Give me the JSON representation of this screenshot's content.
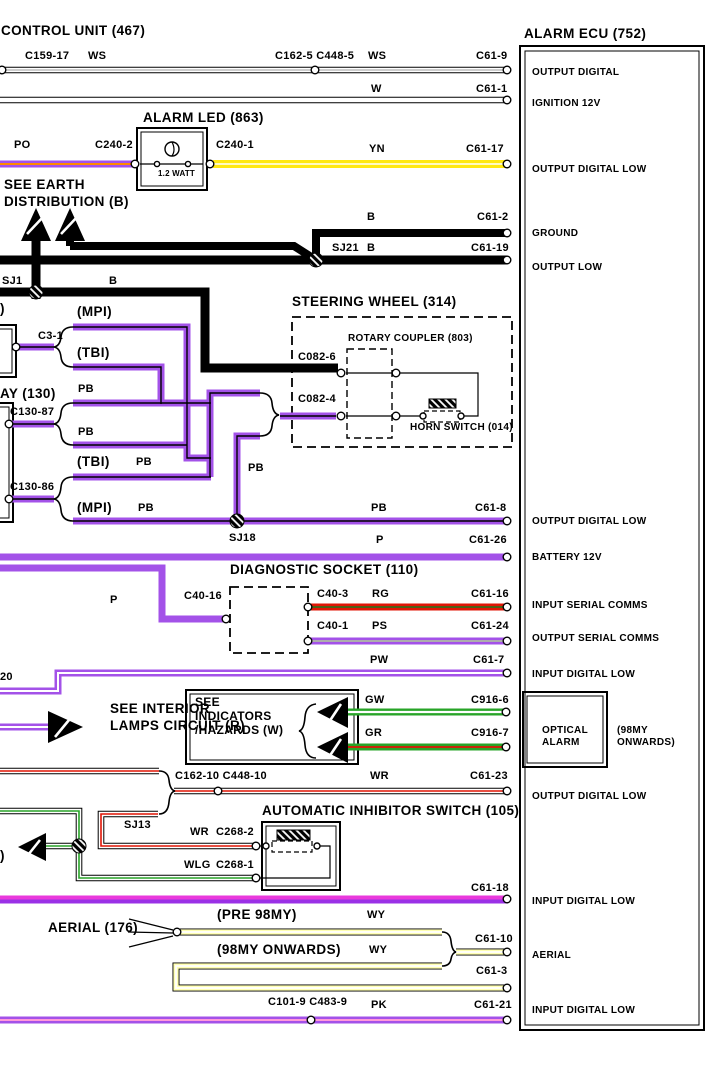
{
  "colors": {
    "purple": "#a352e8",
    "violet": "#9a30e6",
    "magenta": "#e93adc",
    "red": "#e01505",
    "green": "#28a428",
    "yellow": "#ffe813",
    "pale_yellow": "#ffffb4",
    "orange": "#ff8a00",
    "pink": "#ff9ad9",
    "grey": "#adadad",
    "dk_green": "#1d7a1d"
  },
  "header": {
    "control_unit": "CONTROL UNIT (467)"
  },
  "ecu": {
    "title": "ALARM ECU (752)",
    "optical_alarm": {
      "line1": "OPTICAL",
      "line2": "ALARM",
      "note1": "(98MY",
      "note2": "ONWARDS)"
    },
    "pins": [
      {
        "pin": "C61-9",
        "function": "OUTPUT DIGITAL"
      },
      {
        "pin": "C61-1",
        "function": "IGNITION 12V"
      },
      {
        "pin": "C61-17",
        "function": "OUTPUT DIGITAL LOW"
      },
      {
        "pin": "C61-2",
        "function": "GROUND"
      },
      {
        "pin": "C61-19",
        "function": "OUTPUT LOW"
      },
      {
        "pin": "C61-8",
        "function": "OUTPUT DIGITAL LOW"
      },
      {
        "pin": "C61-26",
        "function": "BATTERY 12V"
      },
      {
        "pin": "C61-16",
        "function": "INPUT SERIAL COMMS"
      },
      {
        "pin": "C61-24",
        "function": "OUTPUT SERIAL COMMS"
      },
      {
        "pin": "C61-7",
        "function": "INPUT DIGITAL LOW"
      },
      {
        "pin": "C916-6",
        "function": ""
      },
      {
        "pin": "C916-7",
        "function": ""
      },
      {
        "pin": "C61-23",
        "function": "OUTPUT DIGITAL LOW"
      },
      {
        "pin": "C61-18",
        "function": "INPUT DIGITAL LOW"
      },
      {
        "pin": "C61-10",
        "function": "AERIAL"
      },
      {
        "pin": "C61-3",
        "function": ""
      },
      {
        "pin": "C61-21",
        "function": "INPUT DIGITAL LOW"
      }
    ]
  },
  "components": {
    "alarm_led": {
      "title": "ALARM LED (863)",
      "rating": "1.2 WATT",
      "pin_left": "C240-2",
      "pin_right": "C240-1"
    },
    "steering_wheel": {
      "title": "STEERING WHEEL (314)",
      "rotary_coupler": "ROTARY COUPLER (803)",
      "horn_switch": "HORN SWITCH (014)",
      "pin_top": "C082-6",
      "pin_bottom": "C082-4"
    },
    "relay": {
      "title": "AY (130)",
      "pin_c3": "C3-1",
      "pin_87": "C130-87",
      "pin_86": "C130-86"
    },
    "diagnostic_socket": {
      "title": "DIAGNOSTIC SOCKET (110)",
      "pin_16": "C40-16",
      "pin_3": "C40-3",
      "pin_1": "C40-1"
    },
    "inhibitor_switch": {
      "title": "AUTOMATIC INHIBITOR SWITCH (105)",
      "pin_2": "C268-2",
      "pin_1": "C268-1"
    },
    "aerial": {
      "title": "AERIAL (176)",
      "pre": "(PRE 98MY)",
      "onwards": "(98MY ONWARDS)"
    }
  },
  "references": {
    "earth_line1": "SEE EARTH",
    "earth_line2": "DISTRIBUTION (B)",
    "interior_line1": "SEE INTERIOR",
    "interior_line2": "LAMPS CIRCUIT (R)",
    "indicators_line1": "SEE",
    "indicators_line2": "INDICATORS",
    "indicators_line3": "/HAZARDS (W)"
  },
  "splices": {
    "sj1": "SJ1",
    "sj21": "SJ21",
    "sj18": "SJ18",
    "sj13": "SJ13"
  },
  "inline_connectors": {
    "c159": "C159-17",
    "c162_5": "C162-5 C448-5",
    "c162_10": "C162-10 C448-10",
    "c101": "C101-9 C483-9",
    "cut_20": "20",
    "cut_paren": ")"
  },
  "wire_codes": {
    "ws": "WS",
    "w": "W",
    "po": "PO",
    "yn": "YN",
    "b": "B",
    "mpi": "(MPI)",
    "tbi": "(TBI)",
    "pb": "PB",
    "p": "P",
    "rg": "RG",
    "ps": "PS",
    "pw": "PW",
    "gw": "GW",
    "gr": "GR",
    "wr": "WR",
    "wlg": "WLG",
    "wy": "WY",
    "pk": "PK"
  }
}
